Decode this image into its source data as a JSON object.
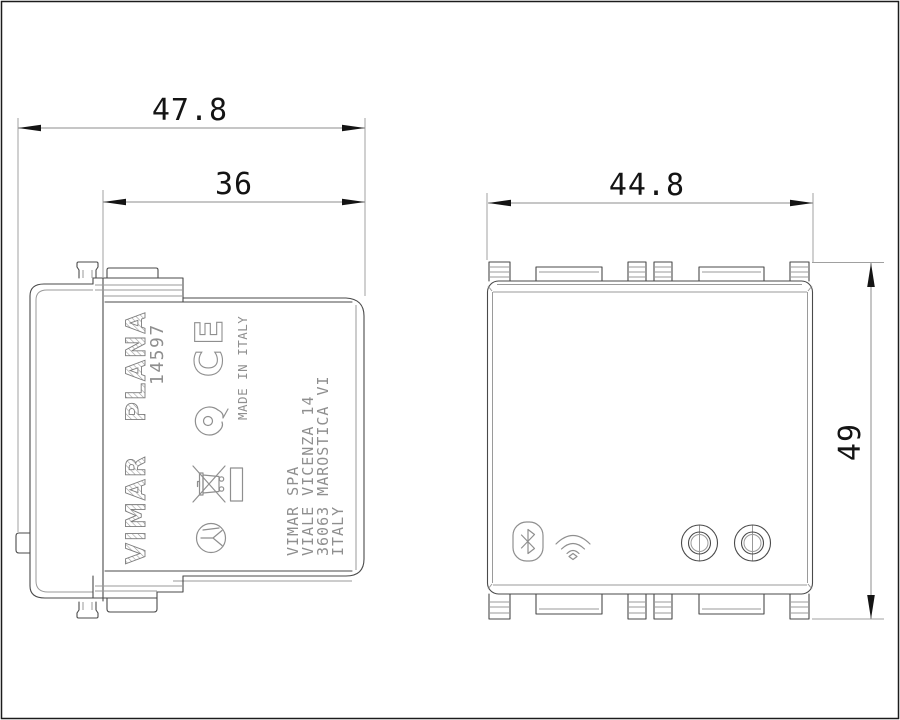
{
  "drawing": {
    "type": "technical-dimensional-drawing",
    "views": {
      "left": "side-profile-view",
      "right": "front-view"
    },
    "dimensions": {
      "overall_depth": "47.8",
      "recess_depth": "36",
      "front_width": "44.8",
      "front_height": "49"
    },
    "marking": {
      "brand": "VIMAR",
      "series": "PLANA",
      "article": "14597",
      "ce_mark": "CE",
      "made_in": "MADE IN ITALY",
      "address": [
        "VIMAR SPA",
        "VIALE VICENZA 14",
        "36063 MAROSTICA VI",
        "ITALY"
      ]
    },
    "icons": [
      "bluetooth-icon",
      "wifi-icon",
      "ce-mark",
      "imq-mark-icon",
      "weee-crossed-bin-icon",
      "rectangle-symbol",
      "circle-fork-symbol"
    ],
    "colors": {
      "background": "#ffffff",
      "outline": "#4a4a4a",
      "dimension_ink": "#141414",
      "print_gray": "#8f8f8f"
    }
  }
}
